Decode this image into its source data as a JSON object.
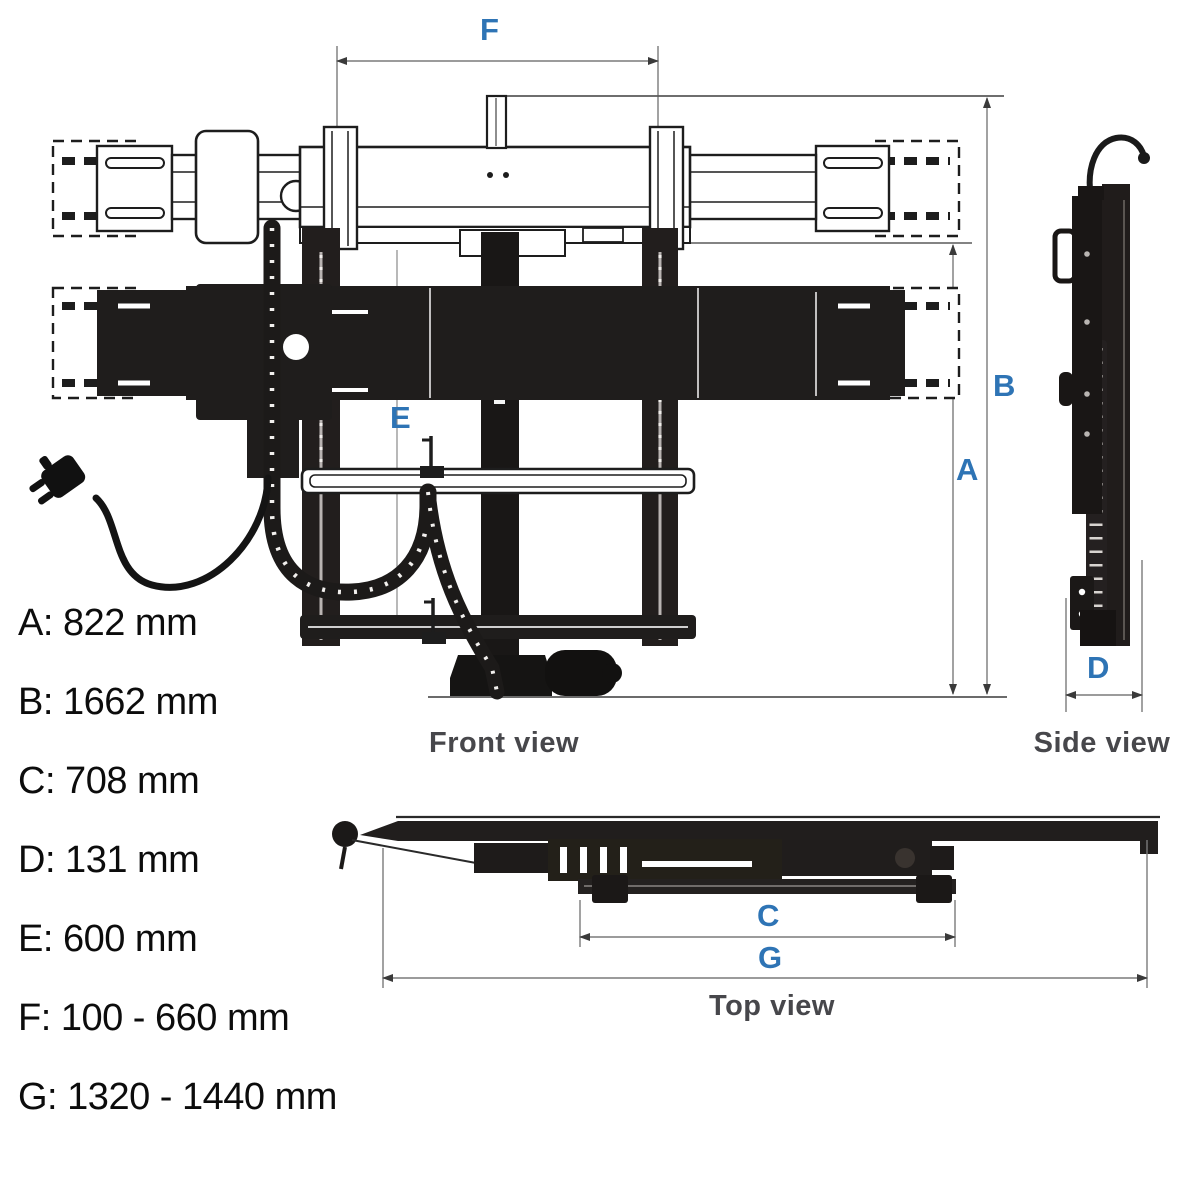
{
  "letters": {
    "A": "A",
    "B": "B",
    "C": "C",
    "D": "D",
    "E": "E",
    "F": "F",
    "G": "G"
  },
  "views": {
    "front": "Front view",
    "side": "Side view",
    "top": "Top view"
  },
  "dimensions": [
    {
      "letter": "A",
      "value": "822 mm",
      "text": "A: 822 mm"
    },
    {
      "letter": "B",
      "value": "1662 mm",
      "text": "B: 1662 mm"
    },
    {
      "letter": "C",
      "value": "708 mm",
      "text": "C: 708 mm"
    },
    {
      "letter": "D",
      "value": "131 mm",
      "text": "D: 131 mm"
    },
    {
      "letter": "E",
      "value": "600 mm",
      "text": "E: 600 mm"
    },
    {
      "letter": "F",
      "value": "100 - 660 mm",
      "text": "F: 100 - 660 mm"
    },
    {
      "letter": "G",
      "value": "1320 - 1440 mm",
      "text": "G: 1320 - 1440 mm"
    }
  ],
  "colors": {
    "dimension_letter_blue": "#2e74b5",
    "view_label_gray": "#47474b",
    "legend_text": "#0c0c0c",
    "drawing_ink": "#1d1d1d",
    "dimension_line_gray": "#7a7a7a",
    "background": "#ffffff"
  }
}
